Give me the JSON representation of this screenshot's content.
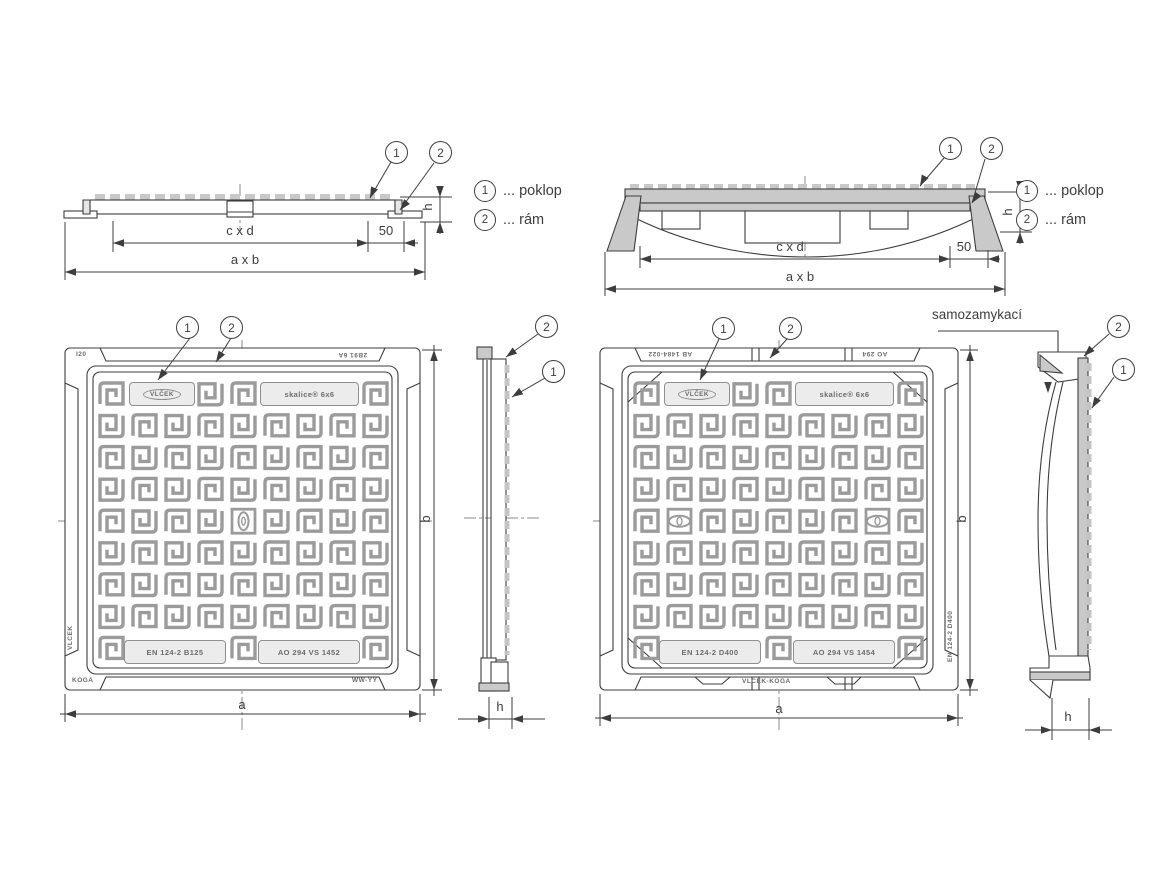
{
  "legend": {
    "one": "1",
    "two": "2",
    "poklop": "... poklop",
    "ram": "... rám"
  },
  "dims": {
    "cxd": "c x d",
    "offset": "50",
    "axb": "a x b",
    "h": "h",
    "a": "a",
    "b": "b"
  },
  "annotations": {
    "selflocking": "samozamykací"
  },
  "cover_b125": {
    "logo": "VLČEK",
    "product": "skalice® 6x6",
    "standard": "EN 124-2 B125",
    "cert": "AO 294 VS 1452",
    "mark_top_left": "I20",
    "mark_top_right": "2B91 6A",
    "mark_bottom_left": "KOGA",
    "mark_bottom_right": "WW-YY",
    "mark_side": "VLCEK"
  },
  "cover_d400": {
    "logo": "VLČEK",
    "product": "skalice® 6x6",
    "standard": "EN 124-2 D400",
    "cert": "AO 294 VS 1454",
    "frame_top_left": "AB 1484-022",
    "frame_top_right": "AO 294",
    "frame_bottom": "VLCEK-KOGA",
    "mark_side": "EN 124-2 D400"
  }
}
